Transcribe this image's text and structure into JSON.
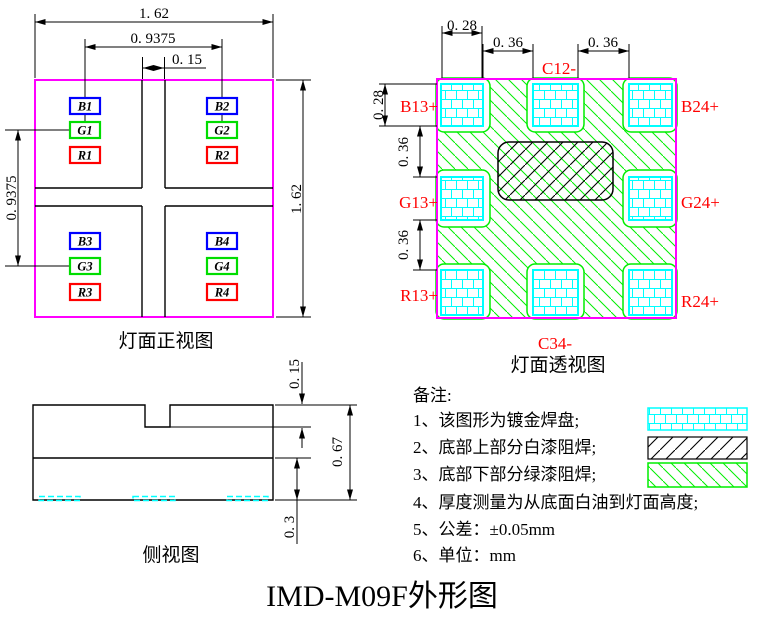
{
  "title": "IMD-M09F外形图",
  "colors": {
    "package_outline": "#FF00FF",
    "gold_pad_grid": "#00FFFF",
    "green_solder_mask": "#00EE00",
    "label_red": "#FF0000",
    "pad_blue": "#0000FF",
    "line_black": "#000000"
  },
  "front_view": {
    "caption": "灯面正视图",
    "dims": {
      "overall_width": "1. 62",
      "pad_pitch_h": "0. 9375",
      "center_gap": "0. 15",
      "pad_pitch_v": "0. 9375",
      "overall_height": "1. 62"
    },
    "pad_labels": [
      "B1",
      "G1",
      "R1",
      "B2",
      "G2",
      "R2",
      "B3",
      "G3",
      "R3",
      "B4",
      "G4",
      "R4"
    ]
  },
  "perspective_view": {
    "caption": "灯面透视图",
    "dims": {
      "pad_width": "0. 28",
      "pad_gap_h1": "0. 36",
      "pad_gap_h2": "0. 36",
      "pad_height": "0. 28",
      "pad_gap_v1": "0. 36",
      "pad_gap_v2": "0. 36"
    },
    "terminals": {
      "c12": "C12-",
      "c34": "C34-",
      "b13": "B13+",
      "g13": "G13+",
      "r13": "R13+",
      "b24": "B24+",
      "g24": "G24+",
      "r24": "R24+"
    }
  },
  "side_view": {
    "caption": "侧视图",
    "dims": {
      "notch_depth": "0. 15",
      "total_height": "0. 67",
      "bottom_layer": "0. 3"
    }
  },
  "notes": {
    "heading": "备注:",
    "items": [
      "1、该图形为镀金焊盘;",
      "2、底部上部分白漆阻焊;",
      "3、底部下部分绿漆阻焊;",
      "4、厚度测量为从底面白油到灯面高度;",
      "5、公差：±0.05mm",
      "6、单位：mm"
    ]
  }
}
